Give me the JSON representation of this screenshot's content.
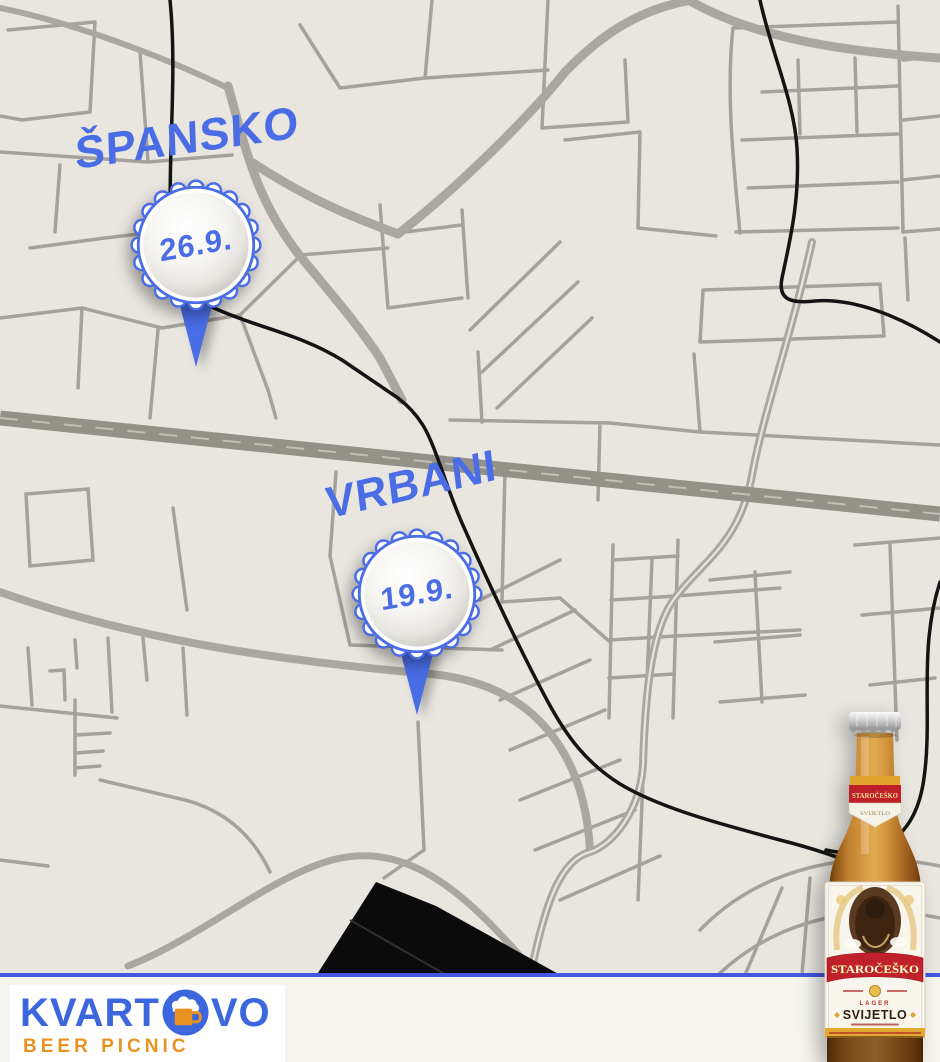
{
  "map": {
    "markers": [
      {
        "name": "ŠPANSKO",
        "date": "26.9."
      },
      {
        "name": "VRBANI",
        "date": "19.9."
      }
    ]
  },
  "footer": {
    "logo": {
      "part1": "KVART",
      "part2": "VO",
      "subtitle": "BEER PICNIC",
      "icon": "beer-mug-icon"
    }
  },
  "bottle": {
    "neck_label": {
      "brand": "STAROČEŠKO",
      "variant": "SVIJETLO"
    },
    "main_label": {
      "brand": "STAROČEŠKO",
      "style": "LAGER",
      "variant": "SVIJETLO"
    }
  },
  "colors": {
    "marker_blue": "#4a6ce4",
    "logo_blue": "#3b66dd",
    "logo_orange": "#e8931f",
    "divider_blue": "#4456e2",
    "map_background": "#e9e6e0",
    "street_gray": "#a5a29c",
    "highway_gray": "#949189",
    "railway_black": "#141414",
    "footer_background": "#f6f4ee",
    "label_red": "#c0202a",
    "label_gold": "#e2a832"
  }
}
